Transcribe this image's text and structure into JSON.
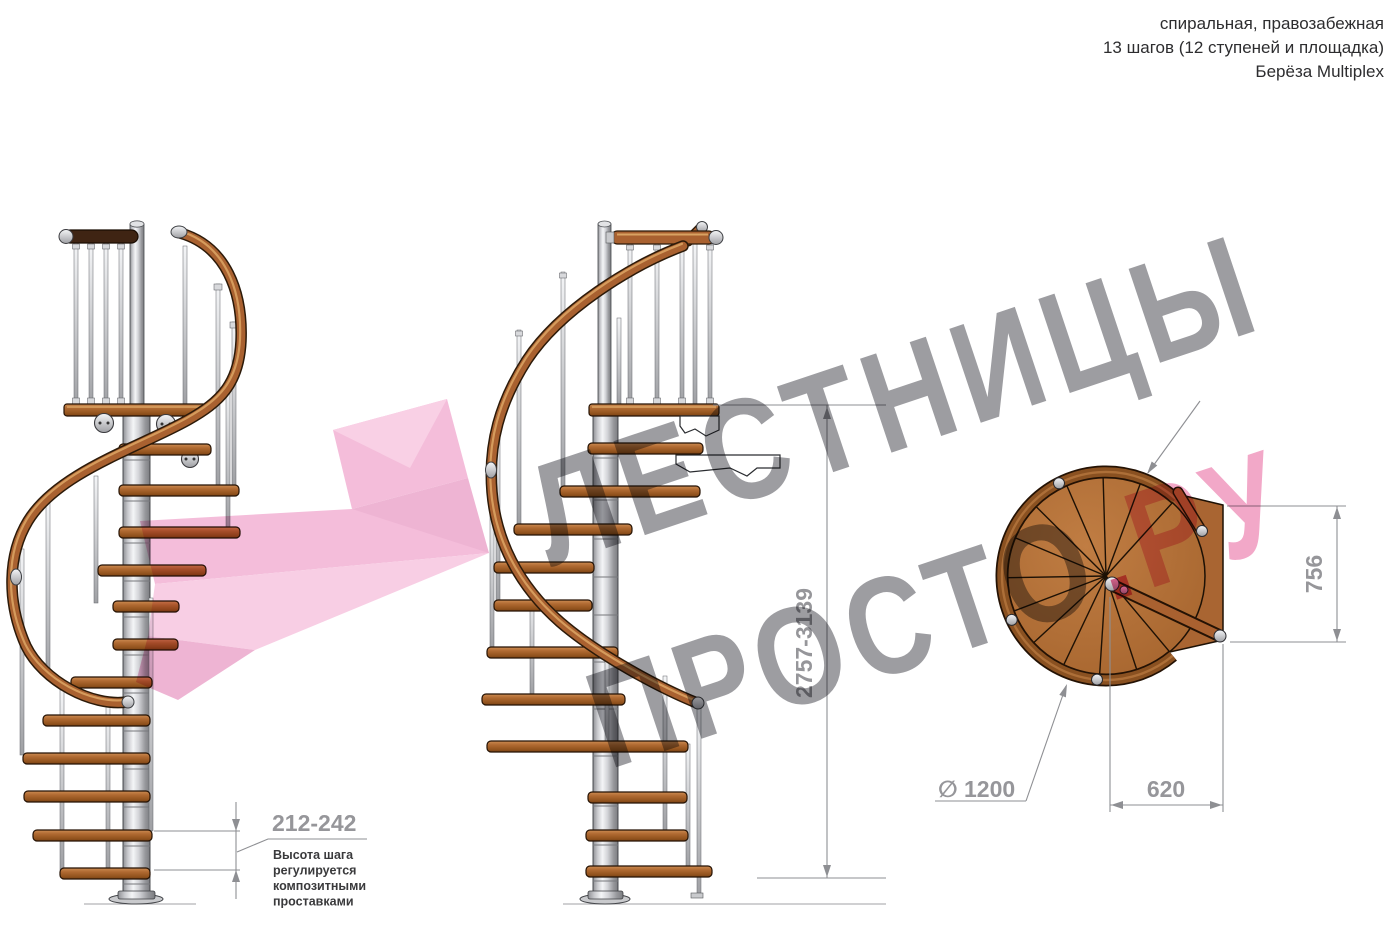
{
  "header": {
    "line1": "спиральная, правозабежная",
    "line2": "13 шагов (12 ступеней и площадка)",
    "line3": "Берёза Multiplex"
  },
  "watermark": {
    "word1": "ЛЕСТНИЦЫ",
    "word2": "ПРОСТО",
    "dot": ".",
    "word3": "РУ"
  },
  "dimensions": {
    "total_height": "2757-3139",
    "step_height": "212-242",
    "step_note_l1": "Высота шага",
    "step_note_l2": "регулируется",
    "step_note_l3": "композитными",
    "step_note_l4": "проставками",
    "diameter_symbol": "∅",
    "diameter_value": "1200",
    "landing_width": "620",
    "landing_depth": "756"
  },
  "colors": {
    "wood": "#a96130",
    "wood_outline": "#2c1a09",
    "tread_light": "#cd8d52",
    "metal_light": "#f4f5f7",
    "metal_dark": "#9fa0a4",
    "dimension_gray": "#96969a",
    "note_text": "#3a3a3c",
    "watermark_gray": "#9d9da1",
    "watermark_pink": "#f2a8c8",
    "watermark_dot_pink": "#e56a95",
    "highlight_pink": "#f2aed2"
  }
}
